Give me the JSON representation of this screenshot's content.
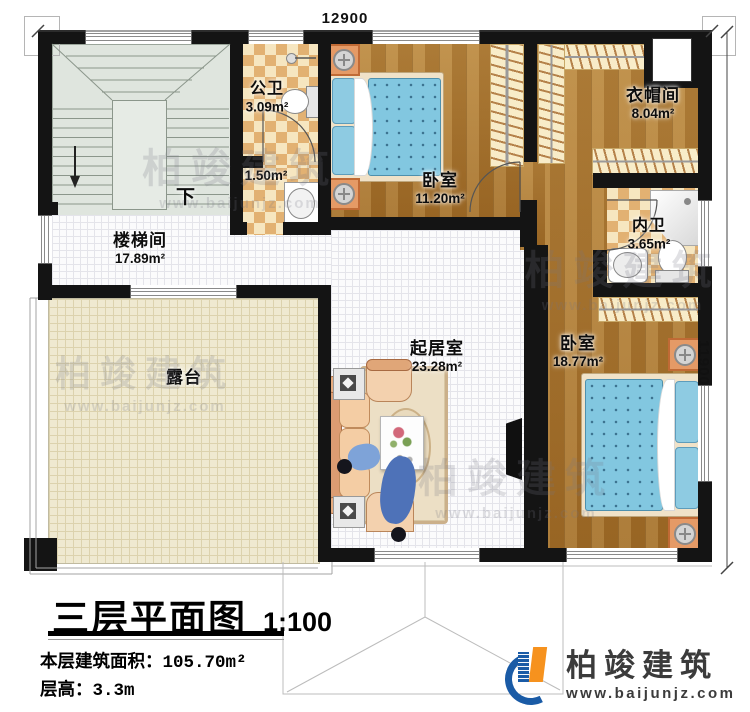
{
  "dimensions": {
    "top": "12900",
    "right": "11900"
  },
  "rooms": {
    "stair_hall": {
      "name": "楼梯间",
      "area": "17.89m²"
    },
    "public_bath": {
      "name": "公卫",
      "area": "3.09m²"
    },
    "anteroom": {
      "area": "1.50m²"
    },
    "bedroom_top": {
      "name": "卧室",
      "area": "11.20m²"
    },
    "cloakroom": {
      "name": "衣帽间",
      "area": "8.04m²"
    },
    "inner_bath": {
      "name": "内卫",
      "area": "3.65m²"
    },
    "living": {
      "name": "起居室",
      "area": "23.28m²"
    },
    "bedroom_right": {
      "name": "卧室",
      "area": "18.77m²"
    },
    "terrace": {
      "name": "露台"
    }
  },
  "annotations": {
    "stair_down": "下"
  },
  "title_block": {
    "title": "三层平面图",
    "scale": "1:100",
    "area_label": "本层建筑面积：",
    "area_value": "105.70m²",
    "height_label": "层高：",
    "height_value": "3.3m"
  },
  "branding": {
    "logo_text": "柏竣建筑",
    "logo_url": "www.baijunjz.com"
  },
  "watermark": {
    "text": "柏竣建筑",
    "url": "www.baijunjz.com"
  },
  "colors": {
    "wall": "#141414",
    "wood": "#b08040",
    "tile": "#fbfbfc",
    "checker_dark": "#e2b172",
    "checker_light": "#f6e6c0",
    "terrace": "#efe9d0",
    "stair": "#dfe5de",
    "bed_blue": "#82c7e0",
    "logo_blue": "#1a5ba6",
    "logo_orange": "#f6921e"
  }
}
